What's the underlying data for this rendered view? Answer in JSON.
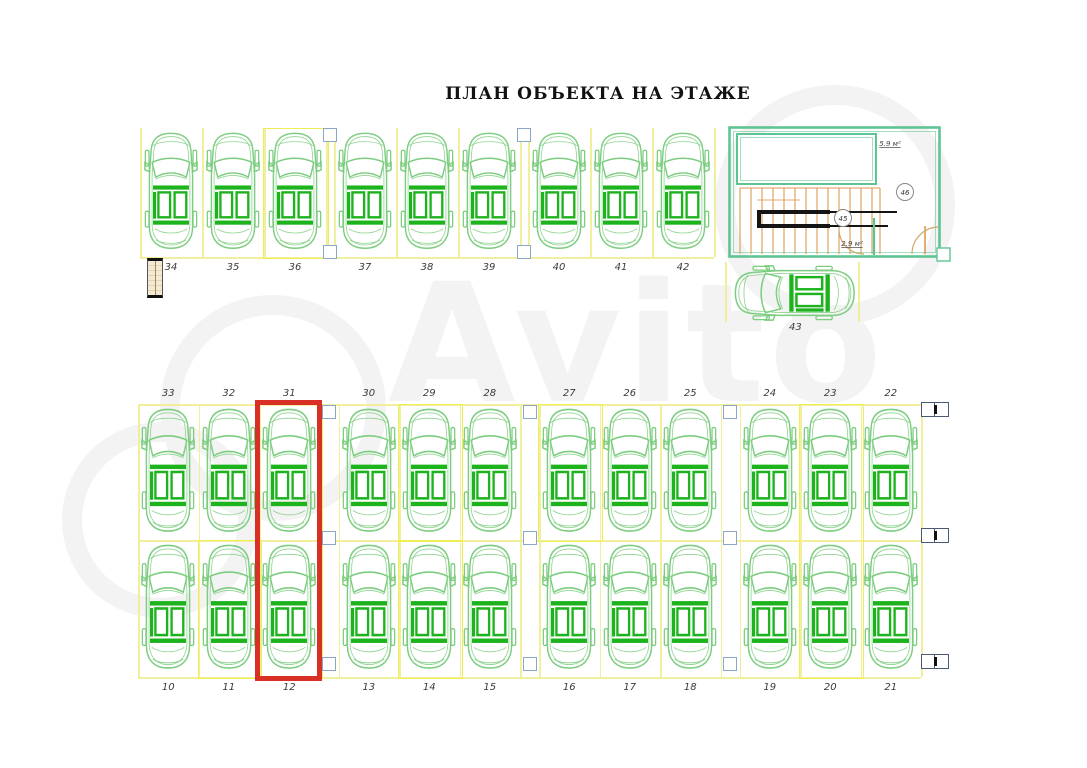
{
  "title": "ПЛАН ОБЪЕКТА НА ЭТАЖЕ",
  "watermark": "Avito",
  "parking": {
    "top_row": [
      "34",
      "35",
      "36",
      "37",
      "38",
      "39",
      "40",
      "41",
      "42"
    ],
    "middle_row": [
      "33",
      "32",
      "31",
      "30",
      "29",
      "28",
      "27",
      "26",
      "25",
      "24",
      "23",
      "22"
    ],
    "bottom_row": [
      "10",
      "11",
      "12",
      "13",
      "14",
      "15",
      "16",
      "17",
      "18",
      "19",
      "20",
      "21"
    ],
    "stair_space": "43",
    "highlighted_spaces": [
      "31",
      "12"
    ]
  },
  "stairwell": {
    "room_label_1": "45",
    "room_label_2": "46",
    "area_label_top": "5.9 м²",
    "area_label_bottom": "2.9 м²"
  },
  "icons": {
    "car": "car-top-view-icon",
    "stairs": "staircase-icon",
    "column": "structural-column-icon"
  },
  "colors": {
    "car_outline": "#7ccd7f",
    "car_accent": "#1db31d",
    "space_line_yellow": "#f2ef9c",
    "space_box_yellow": "#f0ee55",
    "highlight_red": "#d93025",
    "column_blue": "#8aa6c8",
    "wall_teal": "#5fc493",
    "stair_tread_orange": "#dd9a55",
    "watermark_gray": "#f3f3f3"
  }
}
